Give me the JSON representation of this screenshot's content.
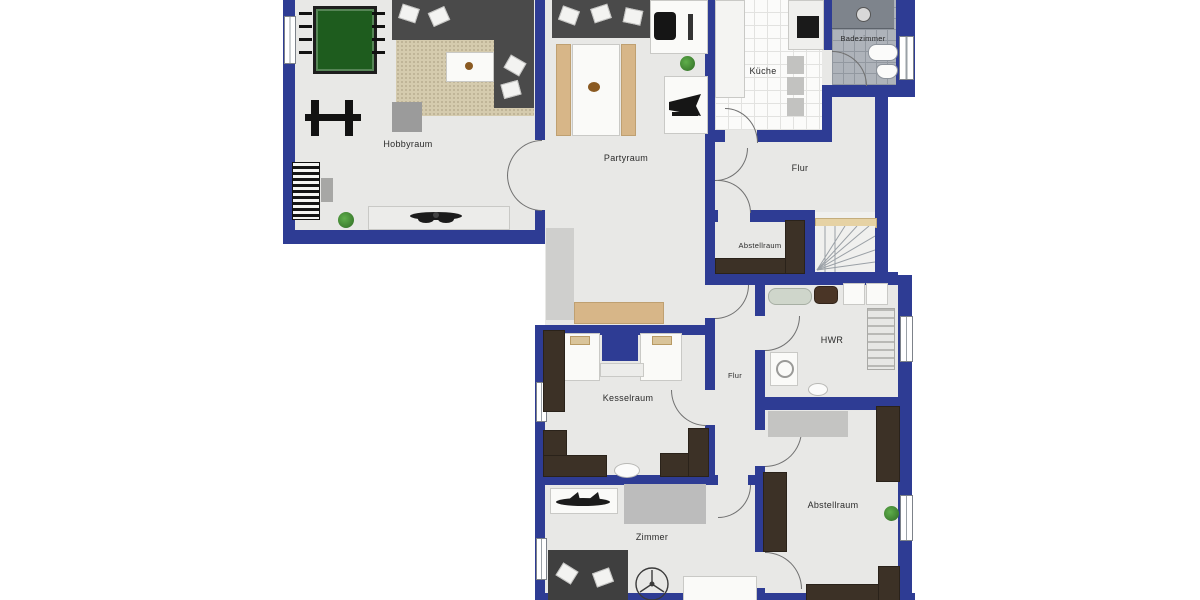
{
  "plan": {
    "title": "Basement floor plan",
    "rooms": [
      {
        "id": "hobbyraum",
        "label": "Hobbyraum"
      },
      {
        "id": "partyraum",
        "label": "Partyraum"
      },
      {
        "id": "kueche",
        "label": "Küche"
      },
      {
        "id": "badezimmer",
        "label": "Badezimmer"
      },
      {
        "id": "flur-upper",
        "label": "Flur"
      },
      {
        "id": "abstellraum-1",
        "label": "Abstellraum"
      },
      {
        "id": "hwr",
        "label": "HWR"
      },
      {
        "id": "flur-lower",
        "label": "Flur"
      },
      {
        "id": "kesselraum",
        "label": "Kesselraum"
      },
      {
        "id": "zimmer",
        "label": "Zimmer"
      },
      {
        "id": "abstellraum-2",
        "label": "Abstellraum"
      }
    ],
    "colors": {
      "wall": "#2e3c94",
      "floor": "#e8e8e6",
      "cabinet": "#3c3126",
      "bench_wood": "#d7b688",
      "rug": "#d5cbae",
      "foosball_green": "#1e5c1e",
      "bath_tile": "#aeb3ba",
      "landing": "#e6d2a4"
    },
    "furniture": {
      "hobbyraum": [
        "foosball-table",
        "corner-sofa",
        "area-rug",
        "coffee-table",
        "ottoman",
        "exercise-machine",
        "piano",
        "piano-bench",
        "sideboard",
        "ceiling-fan",
        "plant"
      ],
      "partyraum": [
        "sofa",
        "dining-table",
        "bench",
        "bench",
        "desk",
        "desk-chair",
        "monitor",
        "grand-piano",
        "runner-rug",
        "wall-bench",
        "plant"
      ],
      "kueche": [
        "counter",
        "counter",
        "cooktop",
        "stool",
        "stool",
        "stool"
      ],
      "badezimmer": [
        "shower",
        "bathtub",
        "toilet"
      ],
      "abstellraum-1": [
        "shelf-cabinet",
        "shelf-cabinet"
      ],
      "stairs": [
        "winder-staircase",
        "landing"
      ],
      "hwr": [
        "ironing-board",
        "laundry-basket",
        "appliance",
        "appliance",
        "drying-rack",
        "washing-machine",
        "sink"
      ],
      "kesselraum": [
        "boiler",
        "boiler",
        "control-panel",
        "cabinet",
        "cabinet",
        "cabinet",
        "floor-drain"
      ],
      "zimmer": [
        "media-shelf",
        "audio-equipment",
        "bed-rug",
        "sofa",
        "ceiling-fan",
        "table"
      ],
      "abstellraum-2": [
        "rug",
        "cabinet",
        "cabinet",
        "cabinet",
        "cabinet",
        "plant"
      ]
    }
  }
}
